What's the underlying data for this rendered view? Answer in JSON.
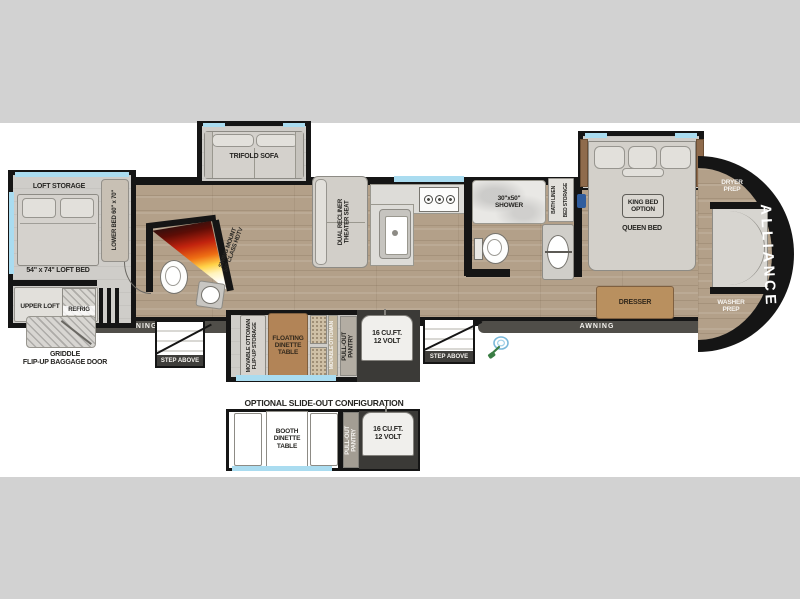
{
  "colors": {
    "background_gray": "#d2d2d2",
    "wall": "#151515",
    "window_blue": "#aadcf0",
    "wood_floor": "#b3a089",
    "wood_furniture": "#b28457",
    "brand_text": "#ffffff"
  },
  "brand": "ALLIANCE",
  "icons": {
    "stove_burner": "gas-burner",
    "outdoor_sprayer": "green-hose-sprayer",
    "tv_swing_arc": "rainbow-swing-fan"
  },
  "rear_loft": {
    "loft_storage": "LOFT STORAGE",
    "loft_bed": "54\" x 74\" LOFT BED",
    "lower_bed": "LOWER BED 60\" x 70\"",
    "upper_loft": "UPPER LOFT",
    "refrig": "REFRIG",
    "griddle": [
      "GRIDDLE",
      "FLIP-UP BAGGAGE DOOR"
    ]
  },
  "living": {
    "trifold_sofa": "TRIFOLD SOFA",
    "theater_seat": [
      "DUAL RECLINER",
      "THEATER SEAT"
    ],
    "swing_tv": [
      "SWING MOUNT",
      "50\" CLASS HDTV"
    ]
  },
  "kitchen_slide": {
    "movable_ottoman": [
      "MOVABLE OTTOMAN",
      "FLIP-UP STORAGE"
    ],
    "floating_dinette": [
      "FLOATING",
      "DINETTE",
      "TABLE"
    ],
    "ottoman_strip": "MOVABLE OTTOMAN",
    "pantry": [
      "PULL-OUT",
      "PANTRY"
    ],
    "fridge": [
      "16 CU.FT.",
      "12 VOLT"
    ]
  },
  "bath": {
    "shower": [
      "30\"x50\"",
      "SHOWER"
    ],
    "bath_linen": "BATH LINEN",
    "bed_storage": "BED STORAGE"
  },
  "bedroom": {
    "king_bed_option": [
      "KING BED",
      "OPTION"
    ],
    "queen_bed": "QUEEN BED",
    "dresser": "DRESSER",
    "dryer_prep": [
      "DRYER",
      "PREP"
    ],
    "washer_prep": [
      "WASHER",
      "PREP"
    ]
  },
  "exterior": {
    "awning_left": "AWNING",
    "awning_right": "AWNING",
    "step_left": "STEP ABOVE",
    "step_right": "STEP ABOVE"
  },
  "optional": {
    "title": "OPTIONAL SLIDE-OUT CONFIGURATION",
    "booth_dinette": [
      "BOOTH",
      "DINETTE",
      "TABLE"
    ],
    "pantry": [
      "PULL-OUT",
      "PANTRY"
    ],
    "fridge": [
      "16 CU.FT.",
      "12 VOLT"
    ]
  }
}
